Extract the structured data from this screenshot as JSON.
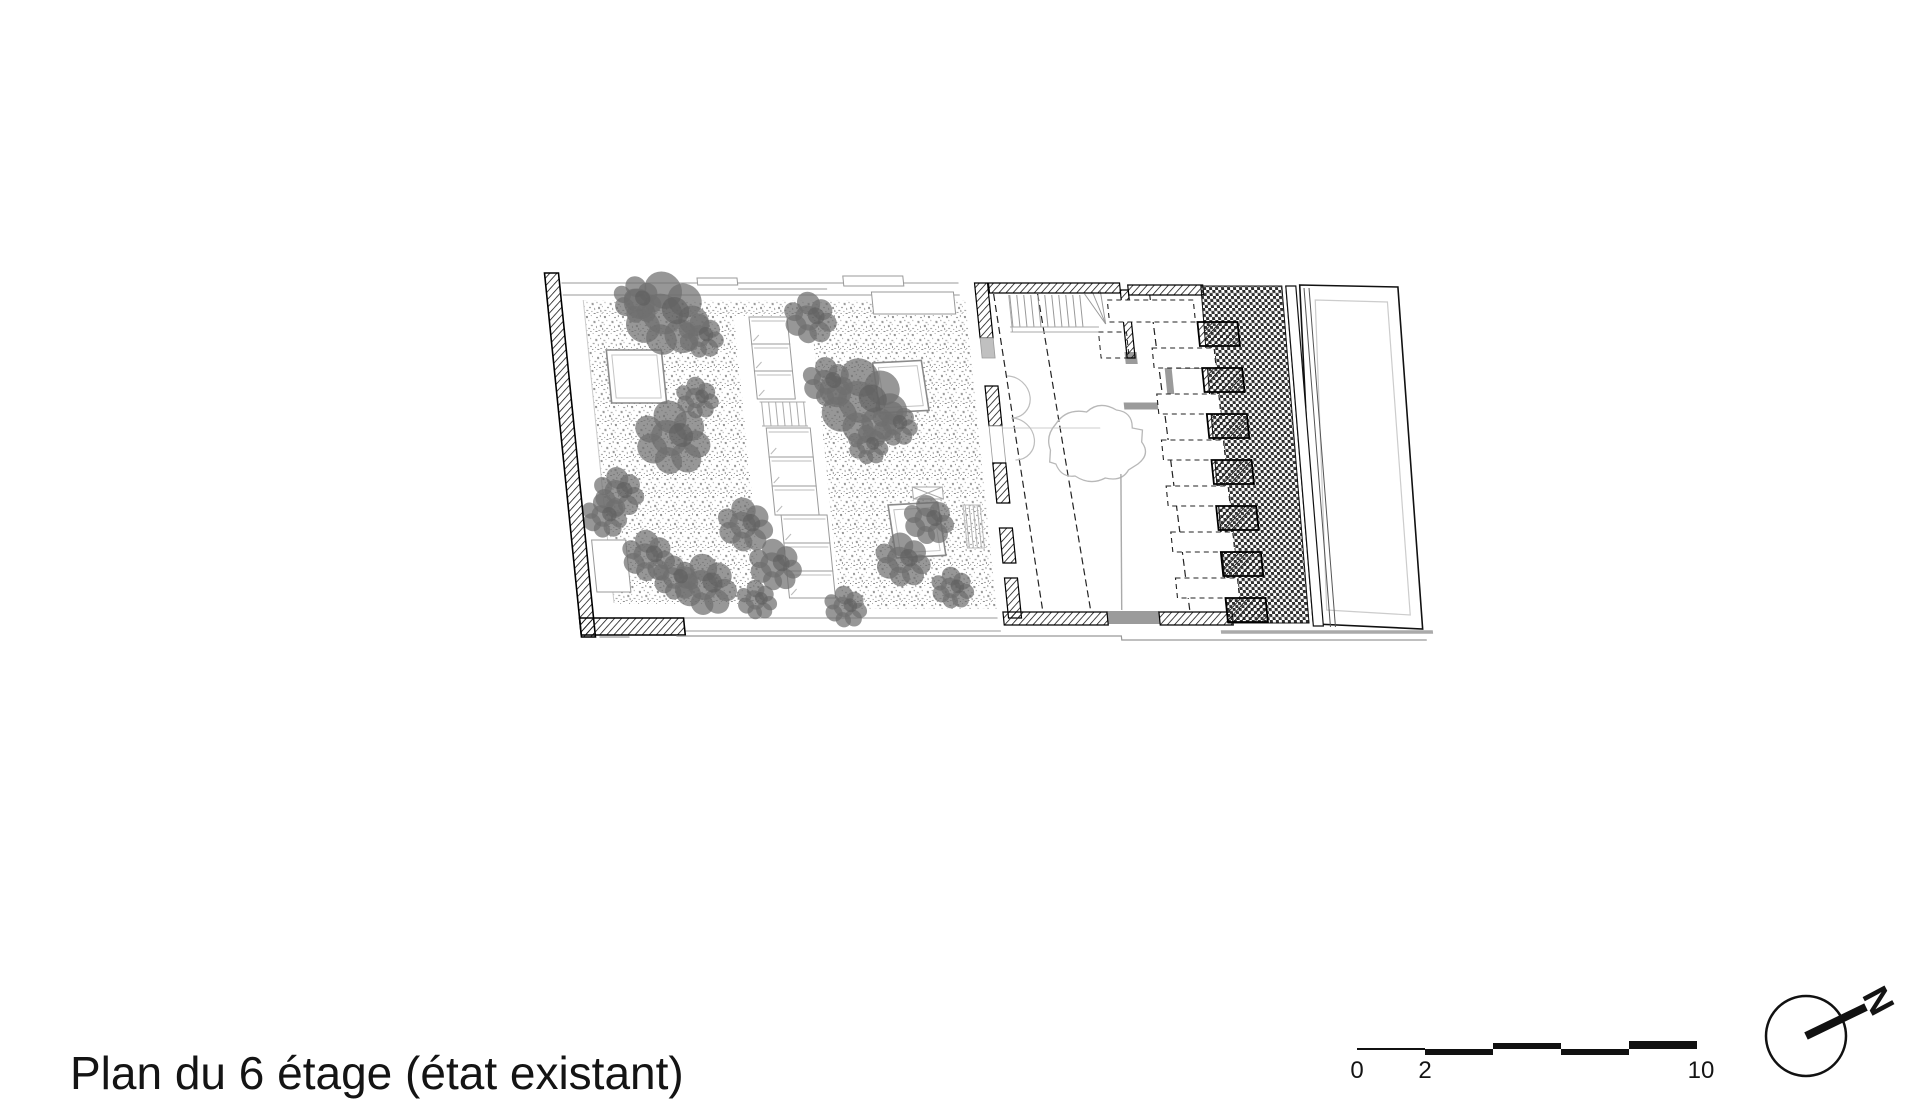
{
  "title": {
    "text": "Plan du 6 étage (état existant)"
  },
  "scale_bar": {
    "labels": {
      "start": "0",
      "mid": "2",
      "end": "10"
    }
  },
  "north_arrow": {
    "label": "N"
  },
  "colors": {
    "ink": "#161616",
    "wall_gray": "#9b9b9b",
    "light_gray": "#c0c0c0",
    "tree_green_gray": "#6f6f6f",
    "background": "#ffffff"
  }
}
